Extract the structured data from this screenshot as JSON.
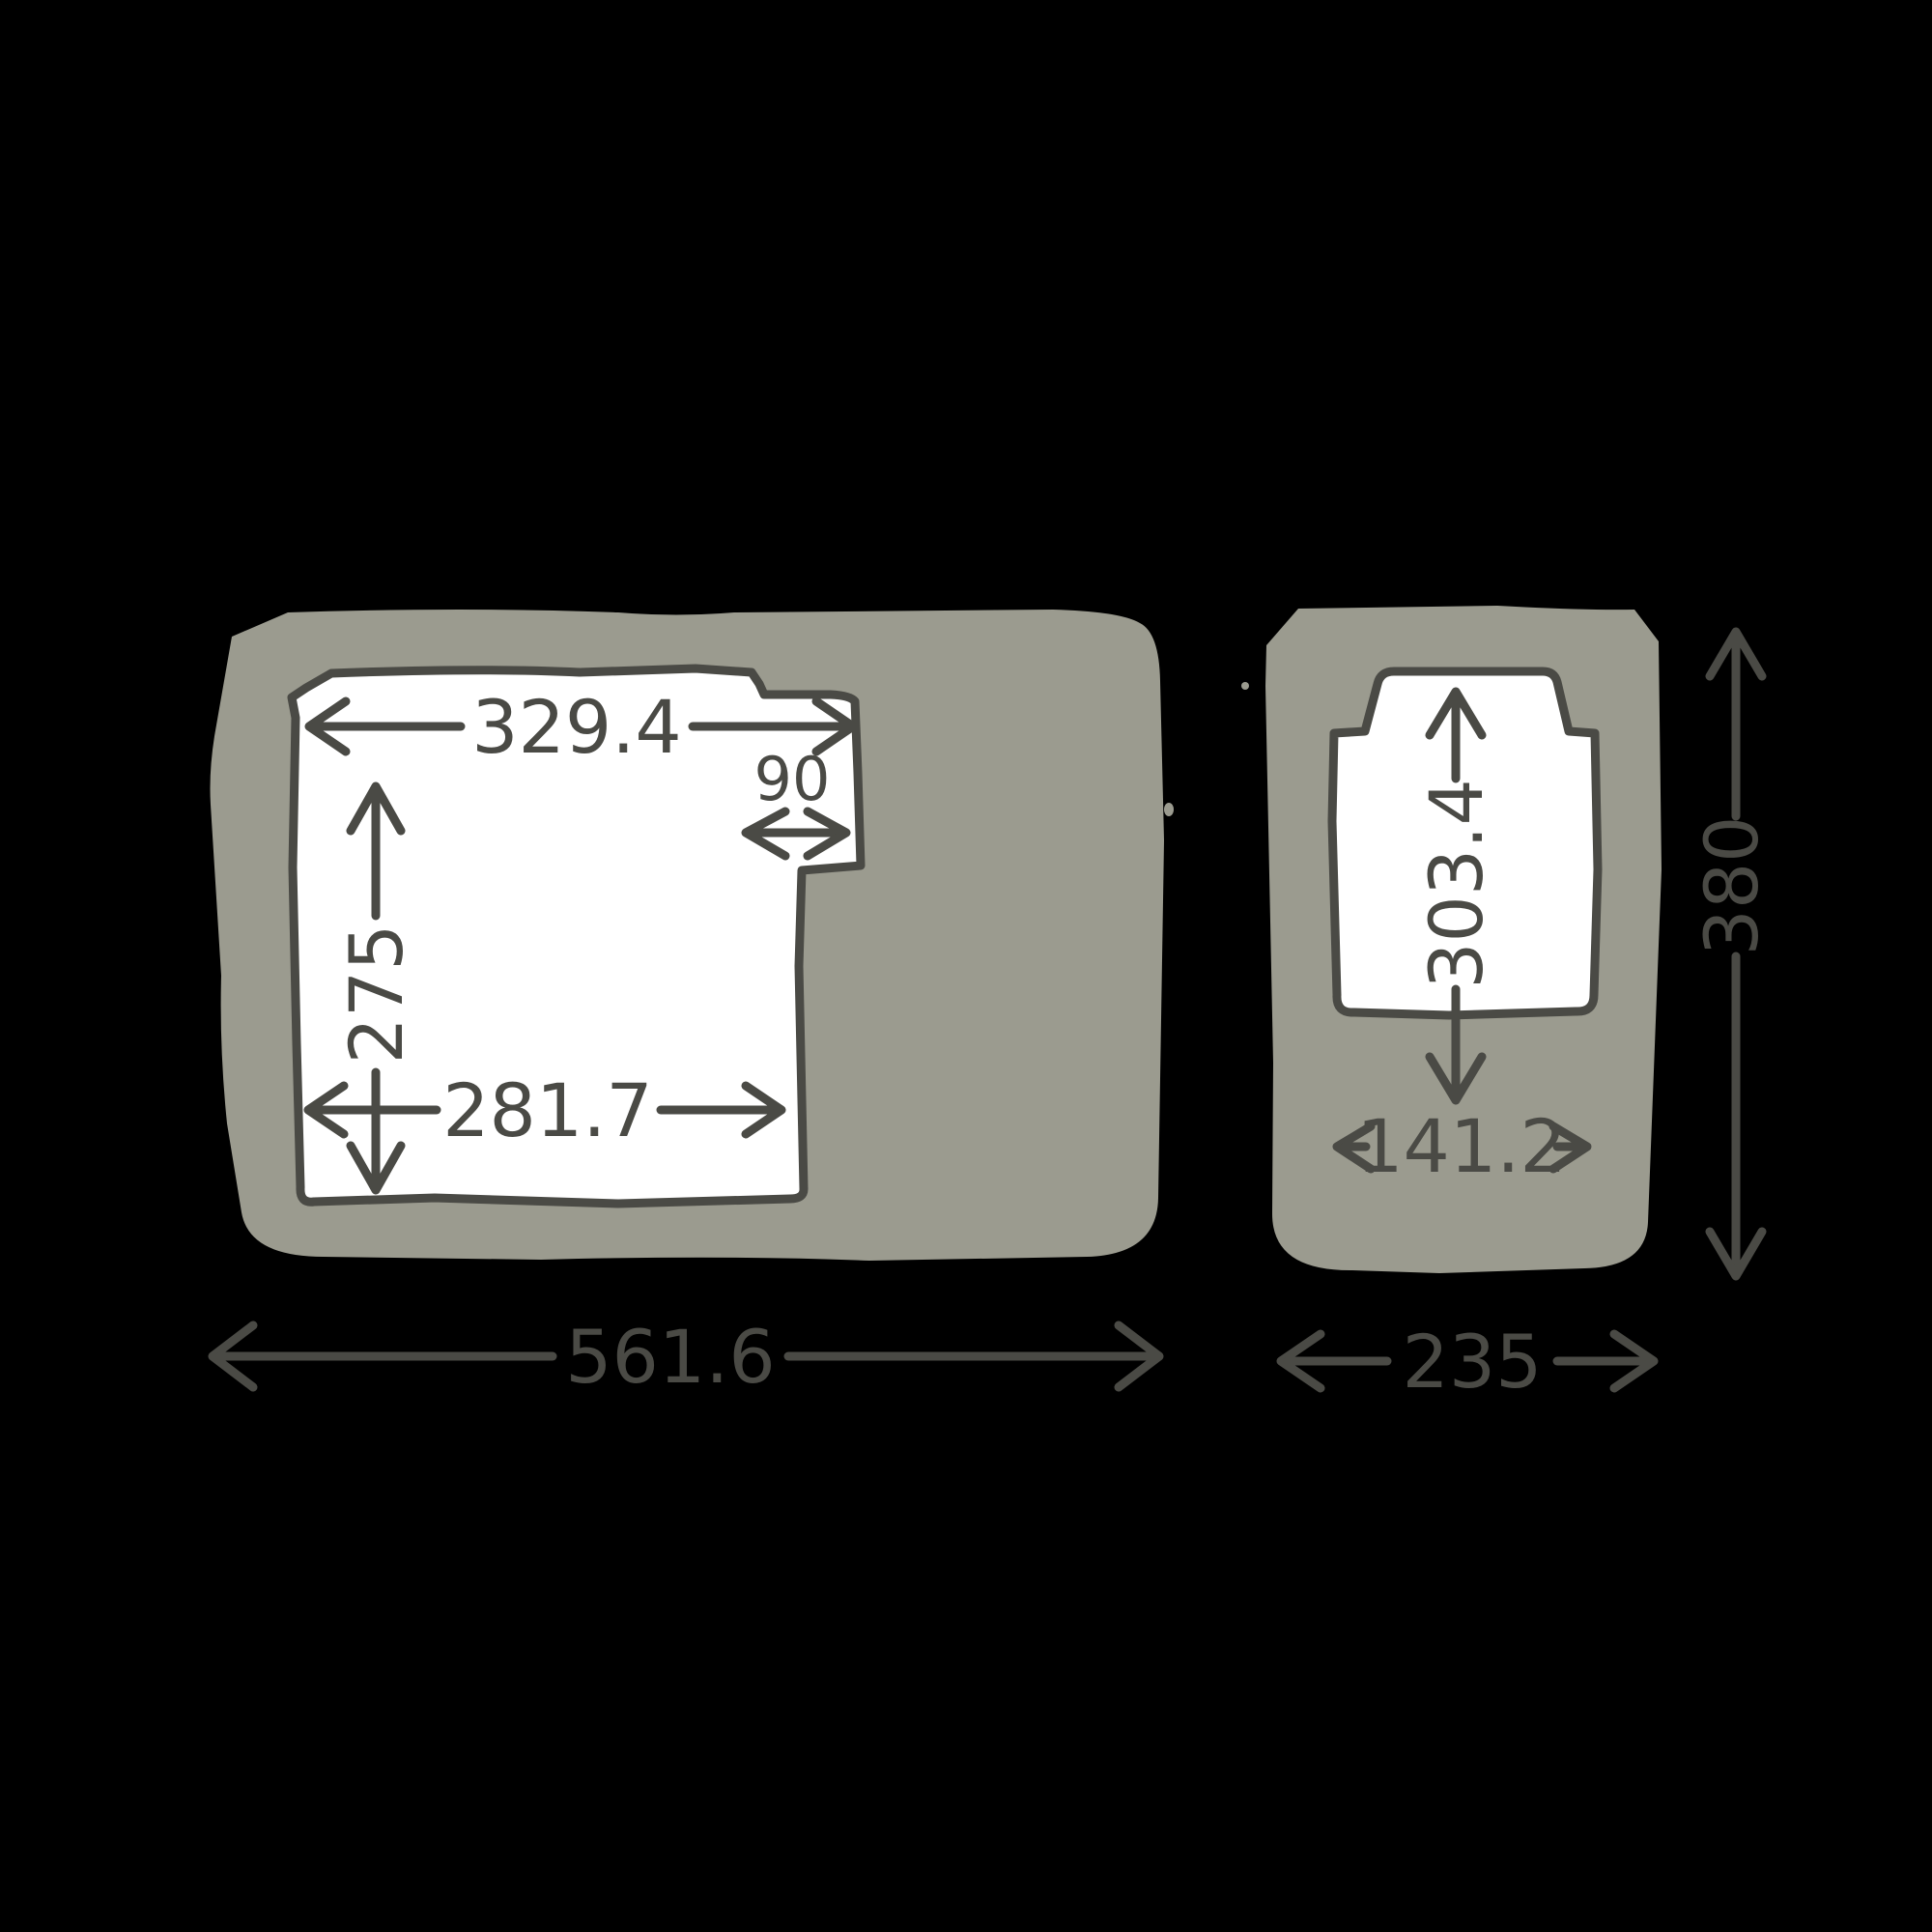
{
  "diagram": {
    "type": "product-dimension-diagram",
    "style": "hand-drawn technical sketch, two orthographic views",
    "colors": {
      "background": "#000000",
      "body_fill": "#9b9b8f",
      "cutout_fill": "#ffffff",
      "line": "#4a4a45"
    },
    "side_view": {
      "name": "left view (side profile with recessed lid opening)",
      "labels": {
        "opening_top_width": "329.4",
        "notch_width": "90",
        "opening_height": "275",
        "opening_bottom_width": "281.7",
        "overall_width": "561.6"
      }
    },
    "front_view": {
      "name": "right view (front profile with recessed opening)",
      "labels": {
        "opening_height": "303.4",
        "opening_width": "141.2",
        "overall_width": "235",
        "overall_height": "380"
      }
    }
  }
}
